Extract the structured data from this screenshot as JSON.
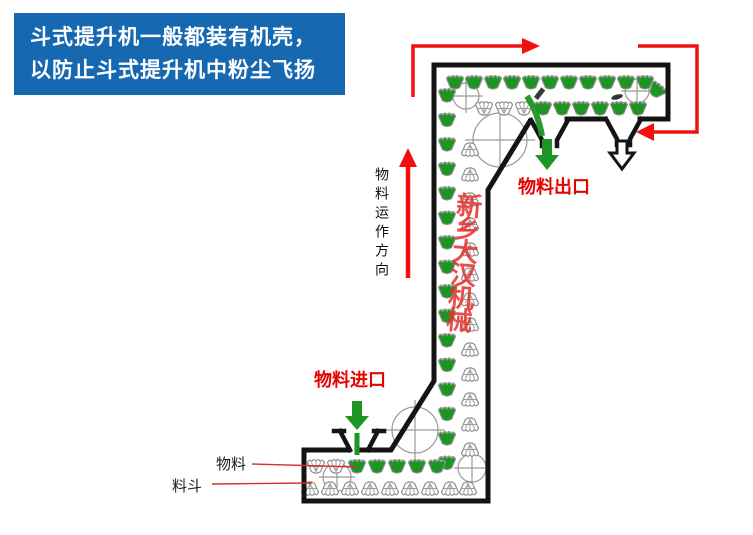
{
  "banner": {
    "line1": "斗式提升机一般都装有机壳，",
    "line2": "以防止斗式提升机中粉尘飞扬",
    "bg_color": "#1668b0",
    "text_color": "#ffffff"
  },
  "labels": {
    "flow_direction": "物料运作方向",
    "material_outlet": "物料出口",
    "material_inlet": "物料进口",
    "material": "物料",
    "bucket": "料斗",
    "watermark": "新乡大汉机械"
  },
  "diagram": {
    "type": "z-type-bucket-elevator-schematic",
    "icons": [
      "full-bucket-icon",
      "empty-bucket-icon",
      "pulley-icon",
      "flow-arrow-icon"
    ],
    "colors": {
      "bucket_green": "#1d9522",
      "flow_arrow_red": "#f01010",
      "label_red": "#e60400",
      "watermark_red": "#e4302c",
      "casing_black": "#141414",
      "bucket_outline_gray": "#8f8f8f"
    }
  }
}
